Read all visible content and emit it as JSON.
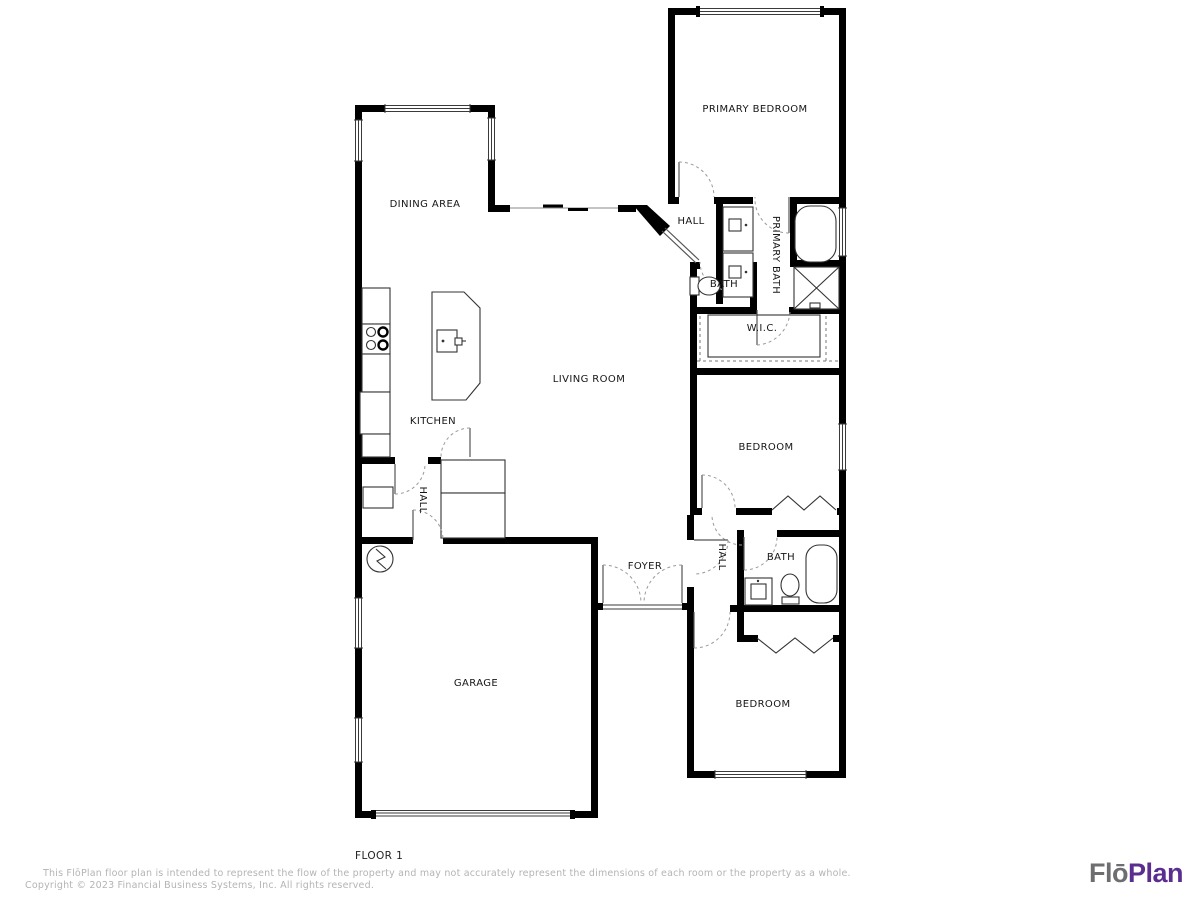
{
  "floor_plan": {
    "floor_label": "FLOOR 1",
    "rooms": [
      {
        "id": "primary-bedroom",
        "label": "PRIMARY BEDROOM"
      },
      {
        "id": "hall-primary",
        "label": "HALL"
      },
      {
        "id": "primary-bath",
        "label": "PRIMARY BATH"
      },
      {
        "id": "bath-primary",
        "label": "BATH"
      },
      {
        "id": "wic",
        "label": "W.I.C."
      },
      {
        "id": "bedroom-middle",
        "label": "BEDROOM"
      },
      {
        "id": "dining-area",
        "label": "DINING AREA"
      },
      {
        "id": "kitchen",
        "label": "KITCHEN"
      },
      {
        "id": "living-room",
        "label": "LIVING ROOM"
      },
      {
        "id": "hall-kitchen",
        "label": "HALL"
      },
      {
        "id": "garage",
        "label": "GARAGE"
      },
      {
        "id": "foyer",
        "label": "FOYER"
      },
      {
        "id": "hall-bedrooms",
        "label": "HALL"
      },
      {
        "id": "bath-hall",
        "label": "BATH"
      },
      {
        "id": "bedroom-lower",
        "label": "BEDROOM"
      }
    ]
  },
  "footer": {
    "disclaimer": "This FlōPlan floor plan is intended to represent the flow of the property and may not accurately represent the dimensions of each room or the property as a whole.",
    "copyright": "Copyright © 2023 Financial Business Systems, Inc. All rights reserved."
  },
  "logo": {
    "part1": "Flō",
    "part2": "Plan",
    "part1_color": "#6d6e71",
    "part2_color": "#5c2d91"
  },
  "colors": {
    "walls": "#000000",
    "room_labels": "#161616",
    "footer_text": "#b4b4b4"
  }
}
